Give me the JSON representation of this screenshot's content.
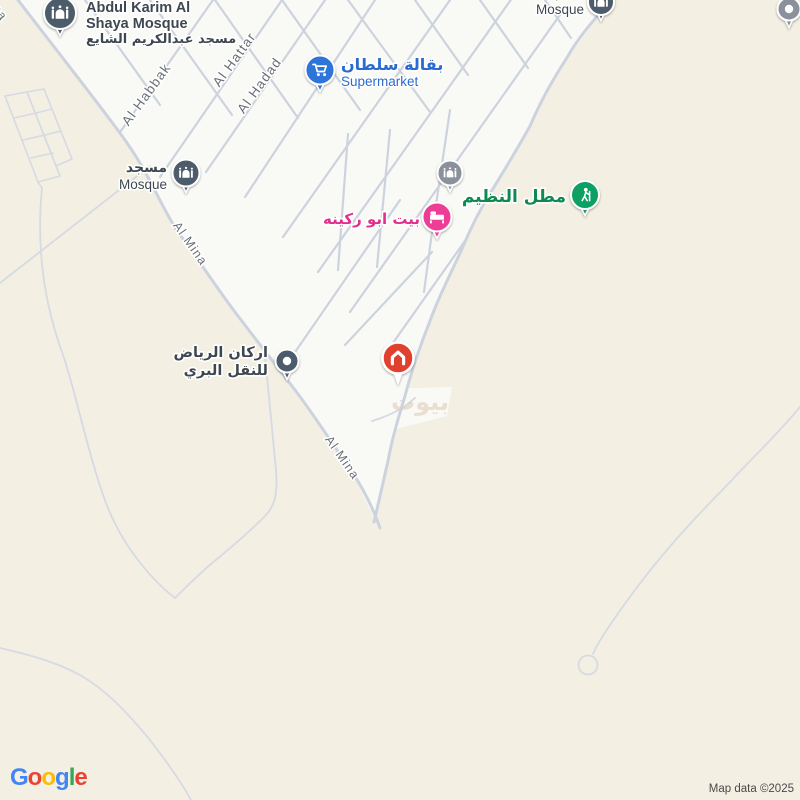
{
  "map": {
    "attribution": "Map data ©2025",
    "watermark": "بيوت",
    "colors": {
      "land": "#f3efe2",
      "urban": "#f9f9f6",
      "road": "#cdd3de",
      "road_thin": "#d5dae3",
      "street_label": "#697076",
      "dark_pin": "#4e5c6a",
      "dark_text": "#3e4750",
      "gray_pin": "#8a919b",
      "blue_pin": "#2e75d9",
      "blue_text": "#2a6bd0",
      "pink_pin": "#ee3d96",
      "pink_text": "#e0308d",
      "green_pin": "#10a063",
      "green_text": "#0c8a50",
      "red_pin": "#e2402f",
      "attribution_text": "#4a4a4c",
      "watermark_color": "#dcc5a9"
    }
  },
  "streets": [
    {
      "label": "Al Mina"
    },
    {
      "label": "Al Habbak"
    },
    {
      "label": "Al Hattar"
    },
    {
      "label": "Al Hadad"
    },
    {
      "label": "Al Mina"
    },
    {
      "label": "Al Mina"
    }
  ],
  "pois": {
    "abdul_karim_mosque": {
      "name_line1": "Abdul Karim Al",
      "name_line2": "Shaya Mosque",
      "name_ar": "مسجد عبدالكريم الشايع"
    },
    "mosque_west": {
      "name_ar": "مسجد",
      "name_en": "Mosque"
    },
    "mosque_north": {
      "name_ar": "مسجد",
      "name_en": "Mosque"
    },
    "supermarket": {
      "name_ar": "بقالة سلطان",
      "name_en": "Supermarket"
    },
    "bait_abu_rukaina": {
      "name_ar": "بيت ابو ركينه"
    },
    "matal_al_nazim": {
      "name_ar": "مطل النظيم"
    },
    "arkan_riyadh": {
      "name_ar_line1": "اركان الرياض",
      "name_ar_line2": "للنقل البري"
    }
  },
  "logo": {
    "label": "Google",
    "letters": [
      {
        "ch": "G",
        "color": "#4285F4"
      },
      {
        "ch": "o",
        "color": "#EA4335"
      },
      {
        "ch": "o",
        "color": "#FBBC05"
      },
      {
        "ch": "g",
        "color": "#4285F4"
      },
      {
        "ch": "l",
        "color": "#34A853"
      },
      {
        "ch": "e",
        "color": "#EA4335"
      }
    ]
  }
}
